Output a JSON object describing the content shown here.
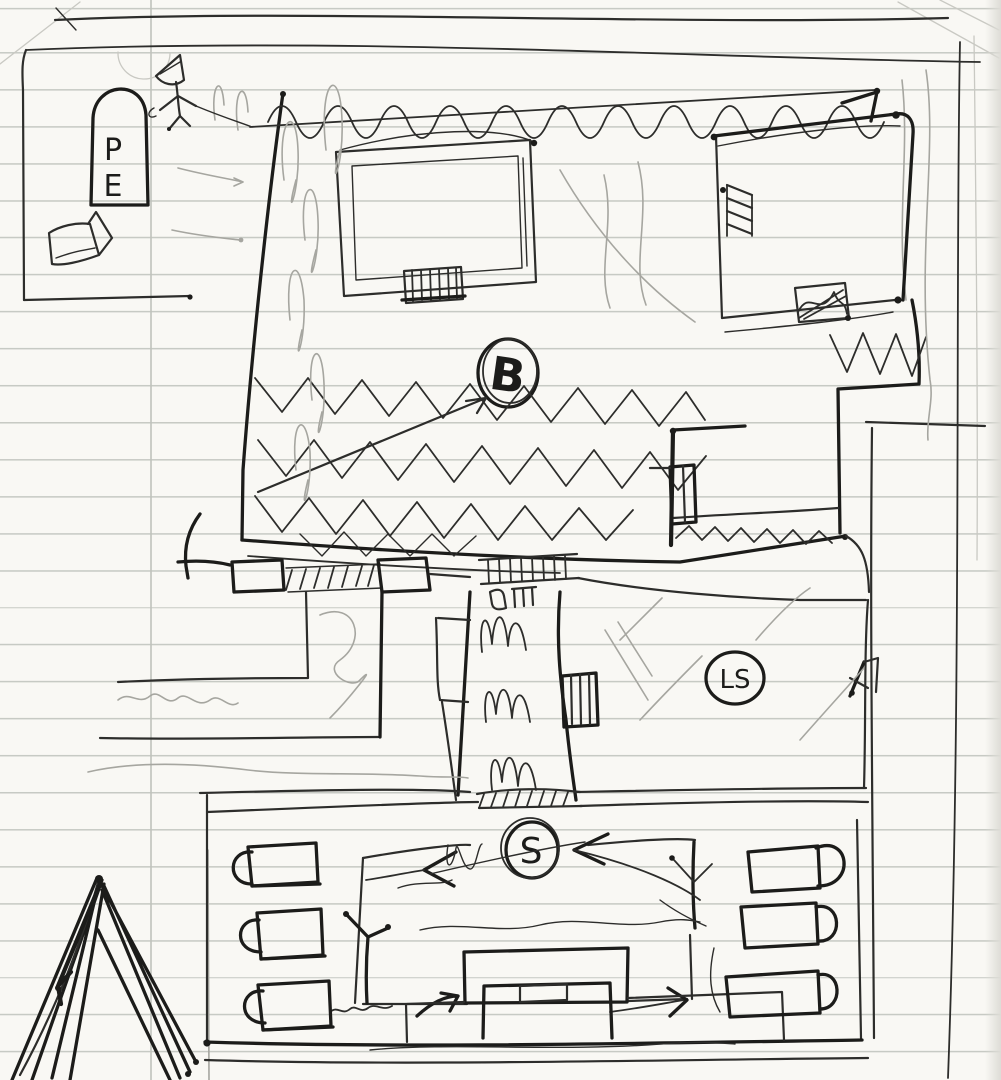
{
  "page": {
    "kind": "hand-drawn floor plan sketch",
    "medium": "ballpoint pen and pencil on ruled notebook paper"
  },
  "labels": {
    "sign_letter_top": "P",
    "sign_letter_bottom": "E",
    "hall_circle": "B",
    "side_room_circle": "LS",
    "assembly_circle": "S"
  },
  "colors": {
    "paper": "#f9f8f4",
    "rule": "#c7cac4",
    "margin": "#bfc2bc",
    "ink": "#2d2d2b",
    "ink_bold": "#1c1c1a",
    "pencil": "#a6a6a0",
    "edge_shadow": "#dddcd6"
  }
}
